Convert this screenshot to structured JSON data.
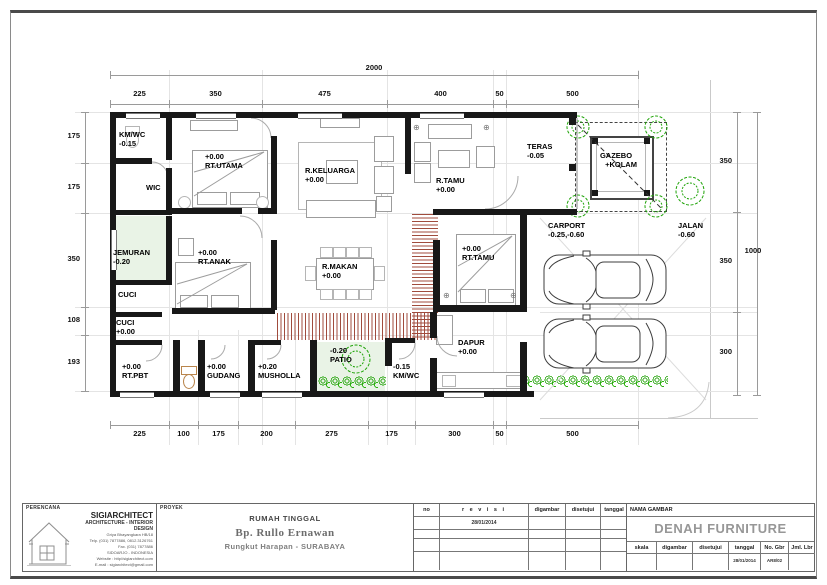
{
  "colors": {
    "wall": "#181818",
    "hatch": "#a04b3c",
    "vegetation": "#23a30a",
    "soft_floor": "#e9f3e6"
  },
  "dims": {
    "top_total": "2000",
    "top": [
      "225",
      "350",
      "475",
      "400",
      "50",
      "500"
    ],
    "bottom": [
      "225",
      "100",
      "175",
      "200",
      "275",
      "175",
      "300",
      "50",
      "500"
    ],
    "left": [
      "175",
      "175",
      "350",
      "108",
      "193"
    ],
    "right": [
      "350",
      "350",
      "300"
    ],
    "right_total": "1000"
  },
  "rooms": {
    "km_wc_top": {
      "line1": "KM/WC",
      "line2": "-0.15"
    },
    "wic": {
      "line1": "WIC"
    },
    "rt_utama": {
      "line1": "+0.00",
      "line2": "RT.UTAMA"
    },
    "r_keluarga": {
      "line1": "R.KELUARGA",
      "line2": "+0.00"
    },
    "r_tamu": {
      "line1": "R.TAMU",
      "line2": "+0.00"
    },
    "teras": {
      "line1": "TERAS",
      "line2": "-0.05"
    },
    "gazebo": {
      "line1": "GAZEBO",
      "line2": "+KOLAM"
    },
    "jemuran": {
      "line1": "JEMURAN",
      "line2": "-0.20"
    },
    "rt_anak": {
      "line1": "+0.00",
      "line2": "RT.ANAK"
    },
    "r_makan": {
      "line1": "R.MAKAN",
      "line2": "+0.00"
    },
    "rt_tamu_guest": {
      "line1": "+0.00",
      "line2": "RT.TAMU"
    },
    "carport": {
      "line1": "CARPORT",
      "line2": "-0.25,-0.60"
    },
    "jalan": {
      "line1": "JALAN",
      "line2": "-0.60"
    },
    "cuci_upper": {
      "line1": "CUCI"
    },
    "cuci_lower": {
      "line1": "CUCI",
      "line2": "+0.00"
    },
    "rt_pbt": {
      "line1": "+0.00",
      "line2": "RT.PBT"
    },
    "gudang": {
      "line1": "+0.00",
      "line2": "GUDANG"
    },
    "musholla": {
      "line1": "+0.20",
      "line2": "MUSHOLLA"
    },
    "patio": {
      "line1": "-0.20",
      "line2": "PATIO"
    },
    "km_wc_btm": {
      "line1": "-0.15",
      "line2": "KM/WC"
    },
    "dapur": {
      "line1": "DAPUR",
      "line2": "+0.00"
    }
  },
  "title_block": {
    "perencana_label": "PERENCANA",
    "firm_name": "SIGIARCHITECT",
    "firm_tagline": "ARCHITECTURE  -  INTERIOR DESIGN",
    "firm_address": [
      "Griya Bhayangkara HB/18",
      "Telp. (031) 7877886, 0812.3126761",
      "Fax. (031) 7877886",
      "SIDOARJO - INDONESIA",
      "Website : http//sigiarchitect.com",
      "E-mail : sigiarchitect@gmail.com"
    ],
    "proyek_label": "PROYEK",
    "project_name": "RUMAH TINGGAL",
    "client": "Bp. Rullo Ernawan",
    "location": "Rungkut Harapan - SURABAYA",
    "rev_headers": {
      "no": "no",
      "revisi": "r e v i s i",
      "digambar": "digambar",
      "disetujui": "disetujui",
      "tanggal": "tanggal"
    },
    "rev_row1_date": "28/01/2014",
    "nama_gambar_label": "NAMA GAMBAR",
    "drawing_title": "DENAH FURNITURE",
    "meta_headers": {
      "skala": "skala",
      "digambar": "digambar",
      "disetujui": "disetujui",
      "tanggal": "tanggal",
      "no_gbr": "No. Gbr",
      "jml_lbr": "Jml. Lbr"
    },
    "meta_tanggal_value": "28/01/2014",
    "meta_no_gbr_value": "AR8/02"
  }
}
